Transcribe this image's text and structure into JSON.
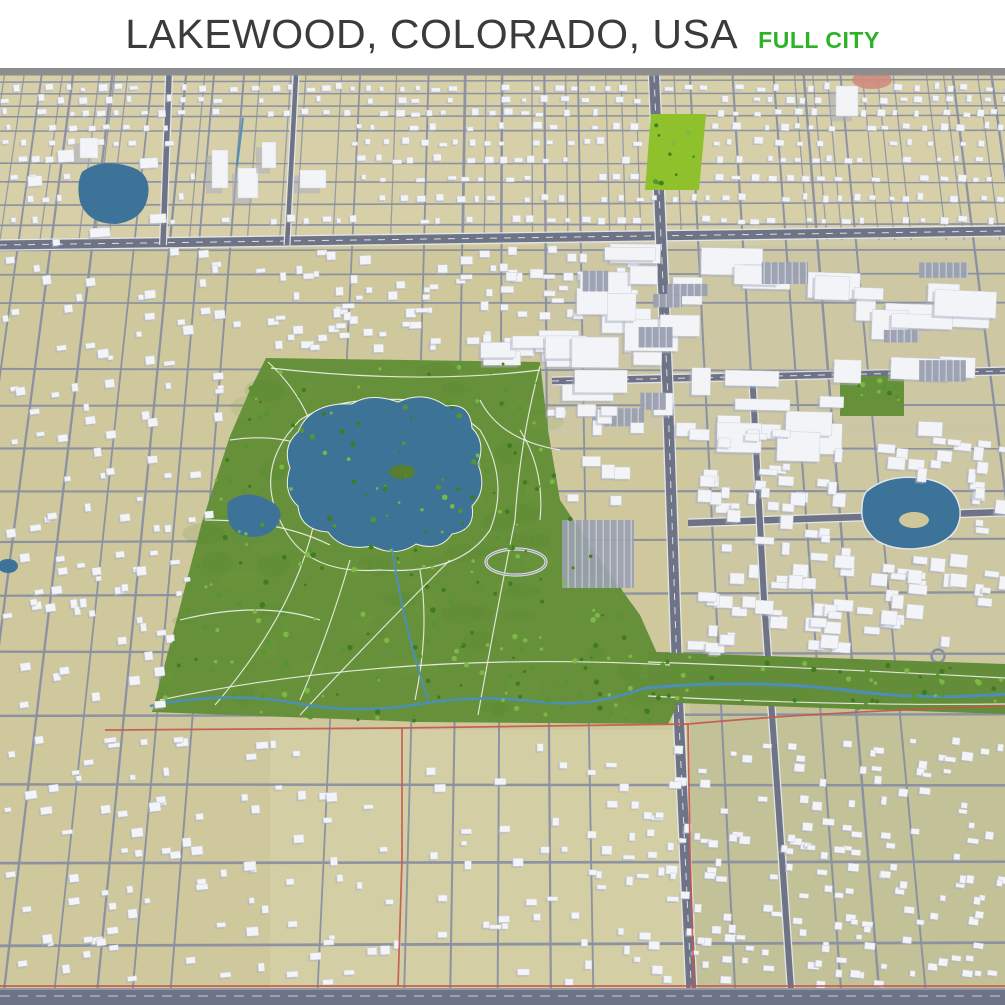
{
  "header": {
    "title": "LAKEWOOD, COLORADO, USA",
    "badge": "FULL CITY"
  },
  "map": {
    "type": "3d-city-aerial-render",
    "city": "Lakewood",
    "state": "Colorado",
    "country": "USA",
    "coverage": "full city",
    "features": [
      "dense suburban residential grid",
      "central park with lake, ponds and trails",
      "creek greenway corridor",
      "commercial big-box district with parking lots",
      "arterial roads and north-south highway",
      "red city boundary line",
      "small neighborhood lakes"
    ],
    "colors": {
      "background": "#ffffff",
      "title_text": "#3b3b3b",
      "badge_text": "#2eb229",
      "horizon_bar": "#8d8d8d",
      "ground": "#cfc89d",
      "ground_light": "#dcd6b0",
      "ground_olive": "#b5ba92",
      "ground_gray": "#c9c6ab",
      "road_minor": "#8a90a2",
      "road_major": "#6e7486",
      "road_edge": "#e6e8ee",
      "road_dash": "#f0f1f5",
      "building": "#f3f4f8",
      "building_edge": "#cdd1da",
      "building_shade": "#a9aec0",
      "parking": "#9aa0b0",
      "parking_stripe": "#c9cdd9",
      "park": "#66913a",
      "park_dark": "#587f30",
      "park_light": "#76a344",
      "tree_dark": "#3f7a20",
      "tree": "#55962c",
      "tree_light": "#7dbb45",
      "water": "#3d7398",
      "water_creek": "#4b8fb8",
      "path": "#f2f4ef",
      "boundary": "#c4574e",
      "field": "#8fc12c",
      "clay": "#cf8b7d",
      "island": "#cfc79b"
    }
  }
}
